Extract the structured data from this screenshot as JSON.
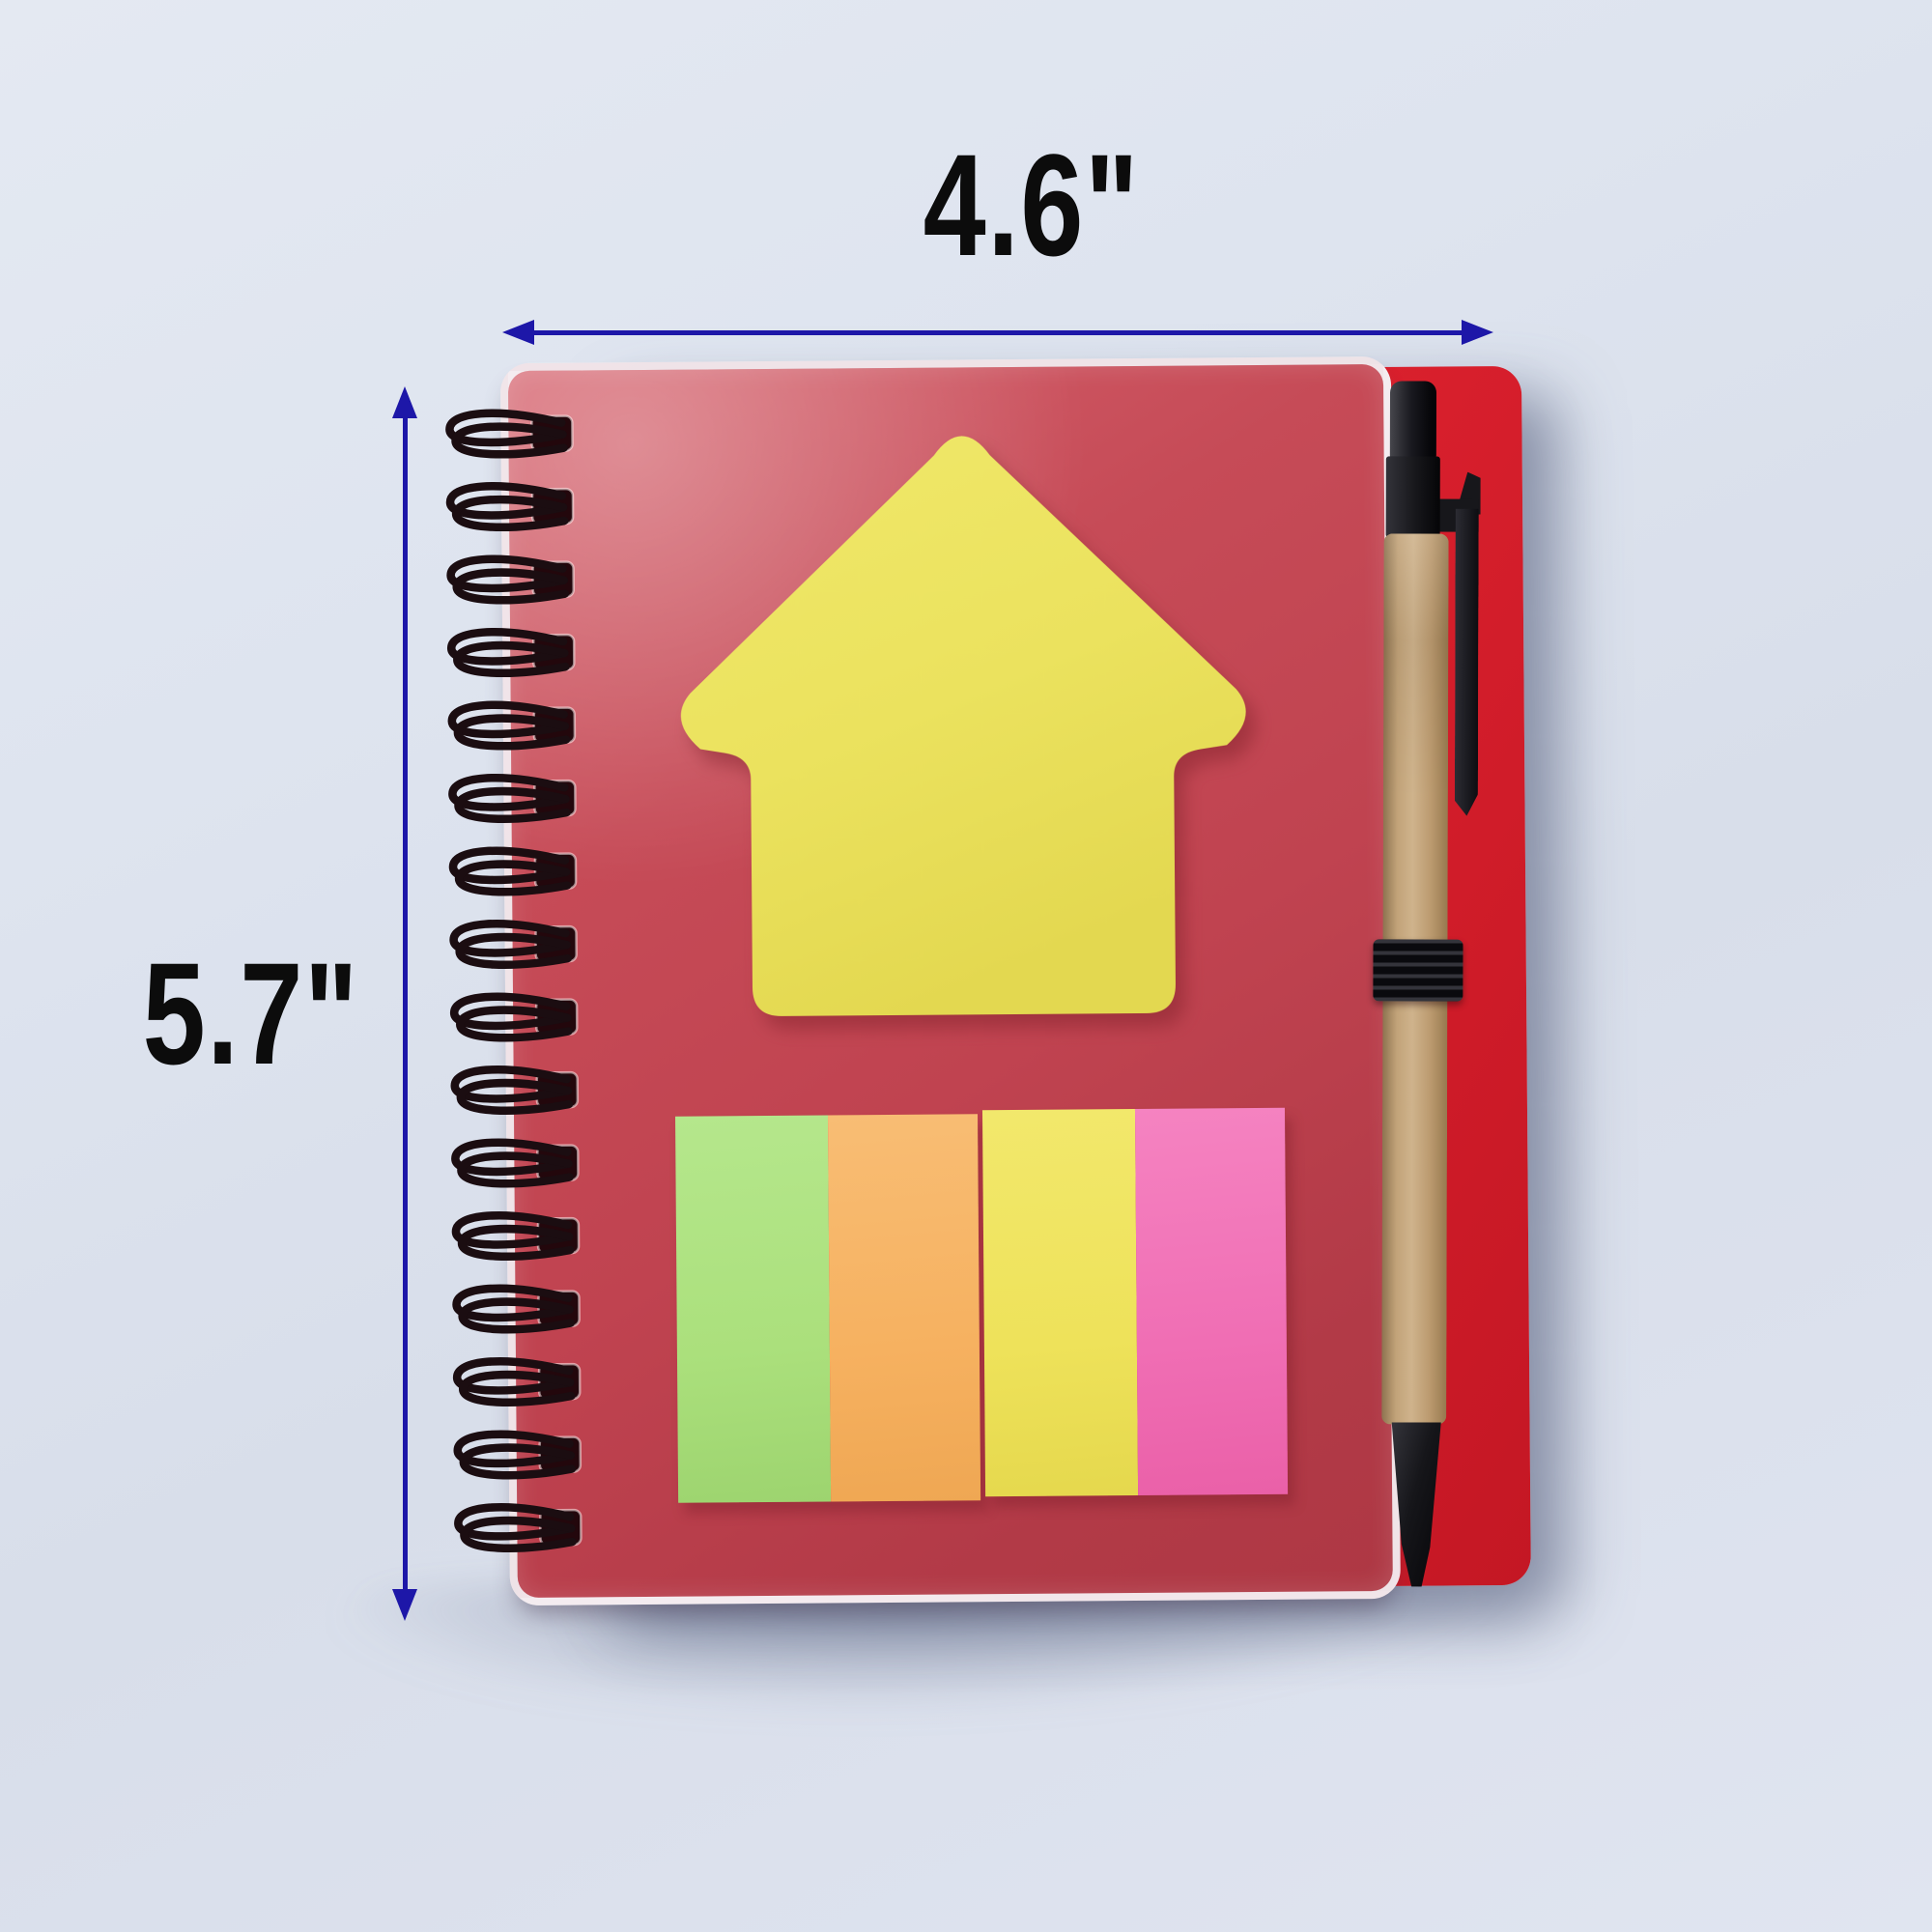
{
  "scene": {
    "description": "Red wire-bound spiral notebook with clear plastic cover, yellow arrow-shaped sticky note pad, four neon page-marker pads, kraft eco pen with black elastic holder, annotated with blue dimension arrows",
    "width_label": "4.6\"",
    "height_label": "5.7\""
  },
  "notebook": {
    "spiral_loop_count": 16,
    "marker_colors": [
      "green",
      "orange",
      "yellow",
      "pink"
    ],
    "sticky_note_shape": "up-arrow"
  },
  "colors": {
    "background": "#dde3ee",
    "dimension_line": "#1d17a8",
    "label_text": "#0c0c0c",
    "cover_red": "#c64b57",
    "back_cover_red": "#dc212e",
    "arrow_note_yellow": "#ebe25e",
    "marker_green": "#abe07c",
    "marker_orange": "#f6b160",
    "marker_yellow": "#eee25a",
    "marker_pink": "#f06eb4",
    "pen_barrel_kraft": "#c2a379",
    "pen_black": "#17171b",
    "spiral_wire": "#1b0d11"
  }
}
